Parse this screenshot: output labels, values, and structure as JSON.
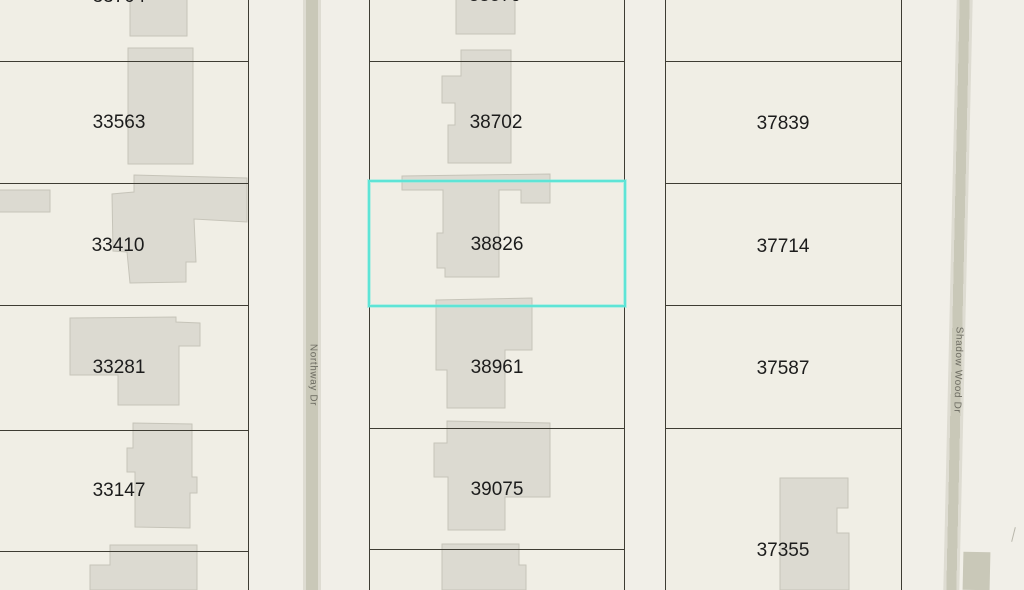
{
  "map_title": "Parcel map view",
  "selection": {
    "parcel": "38826"
  },
  "streets": {
    "left": {
      "name": "Northway Dr"
    },
    "right": {
      "name": "Shadow Wood Dr"
    }
  },
  "parcels": {
    "left": [
      {
        "label": "33704"
      },
      {
        "label": "33563"
      },
      {
        "label": "33410"
      },
      {
        "label": "33281"
      },
      {
        "label": "33147"
      }
    ],
    "middle": [
      {
        "label": "38579"
      },
      {
        "label": "38702"
      },
      {
        "label": "38826"
      },
      {
        "label": "38961"
      },
      {
        "label": "39075"
      }
    ],
    "right": [
      {
        "label": "37839"
      },
      {
        "label": "37714"
      },
      {
        "label": "37587"
      },
      {
        "label": "37355"
      }
    ]
  },
  "colors": {
    "highlight": "#5ee4d6",
    "parcel_line": "#3e3c33",
    "building_fill": "#dcdad1",
    "building_stroke": "#c6c4b9",
    "street_fill": "#c9c8b8",
    "background": "#f1efe8",
    "label_color": "#1c1c1c",
    "street_label_color": "#6e6d63"
  }
}
